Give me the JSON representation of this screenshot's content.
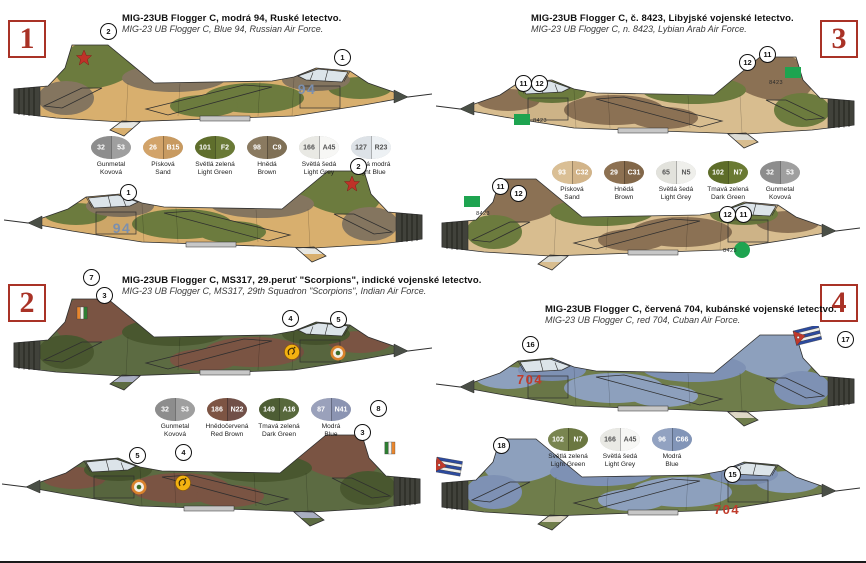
{
  "corners": [
    "1",
    "2",
    "3",
    "4"
  ],
  "schemes": [
    {
      "title_cz": "MIG-23UB Flogger C, modrá 94, Ruské letectvo.",
      "title_en": "MIG-23 UB Flogger C, Blue 94, Russian Air Force.",
      "aircraft_number": "94",
      "number_color": "#7b8fae",
      "markings": {
        "star": "#bf3228"
      },
      "camo": {
        "base": "#d8af6e",
        "p1": "#6c7b3e",
        "p2": "#84755f",
        "belly": "#e7e7e2"
      },
      "swatches": [
        {
          "c1": "32",
          "c2": "53",
          "l1": "Gunmetal",
          "l2": "Kovová",
          "h1": "#8d8d8d",
          "h2": "#9f9f9f",
          "tc": "#ffffff"
        },
        {
          "c1": "26",
          "c2": "B15",
          "l1": "Písková",
          "l2": "Sand",
          "h1": "#d2a369",
          "h2": "#c89a60",
          "tc": "#ffffff"
        },
        {
          "c1": "101",
          "c2": "F2",
          "l1": "Světlá zelená",
          "l2": "Light Green",
          "h1": "#5f6e2c",
          "h2": "#6a7a36",
          "tc": "#ffffff"
        },
        {
          "c1": "98",
          "c2": "C9",
          "l1": "Hnědá",
          "l2": "Brown",
          "h1": "#8a7a60",
          "h2": "#7f7056",
          "tc": "#ffffff"
        },
        {
          "c1": "166",
          "c2": "A45",
          "l1": "Světlá šedá",
          "l2": "Light Grey",
          "h1": "#e9e9e4",
          "h2": "#f7f7f5",
          "tc": "#555555"
        },
        {
          "c1": "127",
          "c2": "R23",
          "l1": "Světlá modrá",
          "l2": "Light Blue",
          "h1": "#dde2e7",
          "h2": "#edf1f4",
          "tc": "#555555"
        }
      ]
    },
    {
      "title_cz": "MIG-23UB Flogger C, MS317, 29.peruť \"Scorpions\", indické vojenské letectvo.",
      "title_en": "MIG-23 UB Flogger C, MS317, 29th Squadron \"Scorpions\", Indian Air Force.",
      "aircraft_number": "",
      "number_color": "#333333",
      "markings": {
        "flash_orange": "#e8862e",
        "flash_green": "#2e7d32",
        "roundel_outer": "#d9822b",
        "roundel_inner": "#f3efe6",
        "roundel_center": "#3a6b2a",
        "scorpion_yellow": "#f3b211"
      },
      "camo": {
        "base": "#5c6b42",
        "p1": "#7a5443",
        "p2": "#49572f",
        "belly": "#a9aec2"
      },
      "swatches": [
        {
          "c1": "32",
          "c2": "53",
          "l1": "Gunmetal",
          "l2": "Kovová",
          "h1": "#8d8d8d",
          "h2": "#9f9f9f",
          "tc": "#ffffff"
        },
        {
          "c1": "186",
          "c2": "N22",
          "l1": "Hnědočervená",
          "l2": "Red Brown",
          "h1": "#7d5443",
          "h2": "#715048",
          "tc": "#ffffff"
        },
        {
          "c1": "149",
          "c2": "A16",
          "l1": "Tmavá zelená",
          "l2": "Dark Green",
          "h1": "#4d5d34",
          "h2": "#57683c",
          "tc": "#ffffff"
        },
        {
          "c1": "87",
          "c2": "N41",
          "l1": "Modrá",
          "l2": "Blue",
          "h1": "#9aa1bb",
          "h2": "#8b94b2",
          "tc": "#ffffff"
        }
      ]
    },
    {
      "title_cz": "MIG-23UB Flogger C, č. 8423, Libyjské vojenské letectvo.",
      "title_en": "MIG-23 UB Flogger C, n. 8423, Lybian Arab Air Force.",
      "aircraft_number": "8423",
      "number_color": "#2f2f2f",
      "markings": {
        "green": "#1ea450"
      },
      "camo": {
        "base": "#d8bd8f",
        "p1": "#8b7154",
        "p2": "#6c7b3e",
        "belly": "#dcdcd5"
      },
      "swatches": [
        {
          "c1": "93",
          "c2": "C32",
          "l1": "Písková",
          "l2": "Sand",
          "h1": "#dabf95",
          "h2": "#d2b489",
          "tc": "#ffffff"
        },
        {
          "c1": "29",
          "c2": "C31",
          "l1": "Hnědá",
          "l2": "Brown",
          "h1": "#8d7152",
          "h2": "#826749",
          "tc": "#ffffff"
        },
        {
          "c1": "65",
          "c2": "N5",
          "l1": "Světlá šedá",
          "l2": "Light Grey",
          "h1": "#e2e2dc",
          "h2": "#efefeb",
          "tc": "#555555"
        },
        {
          "c1": "102",
          "c2": "N7",
          "l1": "Tmavá zelená",
          "l2": "Dark Green",
          "h1": "#5e6d29",
          "h2": "#6a7a33",
          "tc": "#ffffff"
        },
        {
          "c1": "32",
          "c2": "53",
          "l1": "Gunmetal",
          "l2": "Kovová",
          "h1": "#8d8d8d",
          "h2": "#9f9f9f",
          "tc": "#ffffff"
        }
      ]
    },
    {
      "title_cz": "MIG-23UB Flogger C, červená 704, kubánské vojenské letectvo.",
      "title_en": "MIG-23 UB Flogger C, red 704, Cuban Air Force.",
      "aircraft_number": "704",
      "number_color": "#c03b2b",
      "markings": {
        "flag_blue": "#2c4a9e",
        "flag_red": "#c0392b"
      },
      "camo": {
        "base": "#6f7d4b",
        "p1": "#8da0bd",
        "p2": "#7e91b4",
        "belly": "#ded8c6"
      },
      "swatches": [
        {
          "c1": "102",
          "c2": "N7",
          "l1": "Světlá zelená",
          "l2": "Light Green",
          "h1": "#798550",
          "h2": "#6b7741",
          "tc": "#ffffff"
        },
        {
          "c1": "166",
          "c2": "A45",
          "l1": "Světlá šedá",
          "l2": "Light Grey",
          "h1": "#e9e9e4",
          "h2": "#f7f7f5",
          "tc": "#555555"
        },
        {
          "c1": "96",
          "c2": "C66",
          "l1": "Modrá",
          "l2": "Blue",
          "h1": "#92a2c1",
          "h2": "#8295b8",
          "tc": "#ffffff"
        }
      ]
    }
  ],
  "callouts": {
    "s1a": [
      "2",
      "1"
    ],
    "s1b": [
      "1",
      "2"
    ],
    "s2a": [
      "7",
      "3",
      "4",
      "5"
    ],
    "s2b": [
      "5",
      "4",
      "8",
      "3"
    ],
    "s3a": [
      "11",
      "12",
      "12",
      "11"
    ],
    "s3b": [
      "11",
      "12",
      "12",
      "11"
    ],
    "s4a": [
      "16",
      "17"
    ],
    "s4b": [
      "18",
      "15"
    ]
  }
}
